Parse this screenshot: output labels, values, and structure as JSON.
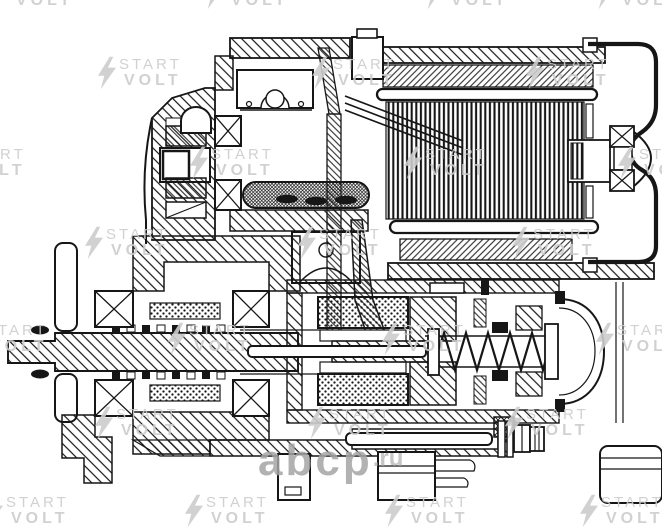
{
  "colors": {
    "paper": "#ffffff",
    "ink": "#161616",
    "brand_watermark": "#cccccc",
    "site_watermark": "#a5a5a5"
  },
  "brand_watermark": {
    "line1": "START",
    "line2": "VOLT"
  },
  "site_watermark": {
    "name": "abcp",
    "tld": ".ru"
  },
  "watermark_tiles": [
    [
      -10,
      -24
    ],
    [
      205,
      -24
    ],
    [
      425,
      -24
    ],
    [
      596,
      -24
    ],
    [
      98,
      56
    ],
    [
      312,
      56
    ],
    [
      526,
      56
    ],
    [
      -58,
      146
    ],
    [
      190,
      146
    ],
    [
      404,
      146
    ],
    [
      618,
      146
    ],
    [
      85,
      226
    ],
    [
      298,
      226
    ],
    [
      512,
      226
    ],
    [
      -36,
      322
    ],
    [
      168,
      322
    ],
    [
      382,
      322
    ],
    [
      596,
      322
    ],
    [
      95,
      406
    ],
    [
      308,
      406
    ],
    [
      505,
      406
    ],
    [
      -15,
      494
    ],
    [
      185,
      494
    ],
    [
      385,
      494
    ],
    [
      580,
      494
    ]
  ]
}
